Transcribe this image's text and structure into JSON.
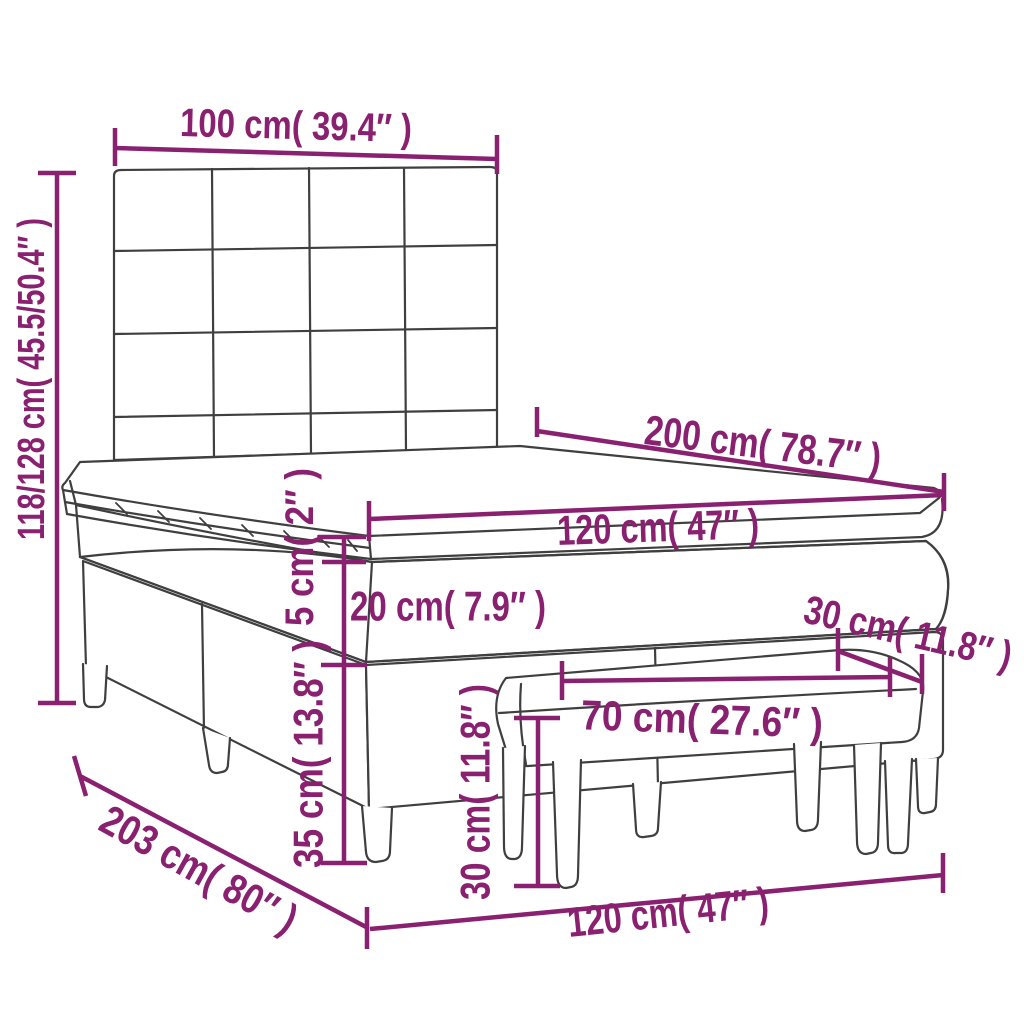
{
  "diagram": {
    "title": "Box spring bed with headboard, topper and bench — dimension drawing",
    "outline_color": "#3f3f3f",
    "dimension_color": "#8a2070",
    "background_color": "#ffffff",
    "dims": {
      "headboard_width": "100 cm( 39.4″ )",
      "bed_height": "118/128 cm( 45.5/50.4″ )",
      "mattress_length": "200 cm( 78.7″ )",
      "mattress_width": "120 cm( 47″ )",
      "topper_height": "5 cm( 2″ )",
      "mattress_height": "20 cm( 7.9″ )",
      "base_height": "35 cm( 13.8″ )",
      "bench_depth": "30 cm( 11.8″ )",
      "bench_length": "70 cm( 27.6″ )",
      "bench_height": "30 cm( 11.8″ )",
      "total_length": "203 cm( 80″ )",
      "bed_width": "120 cm( 47″ )"
    }
  }
}
